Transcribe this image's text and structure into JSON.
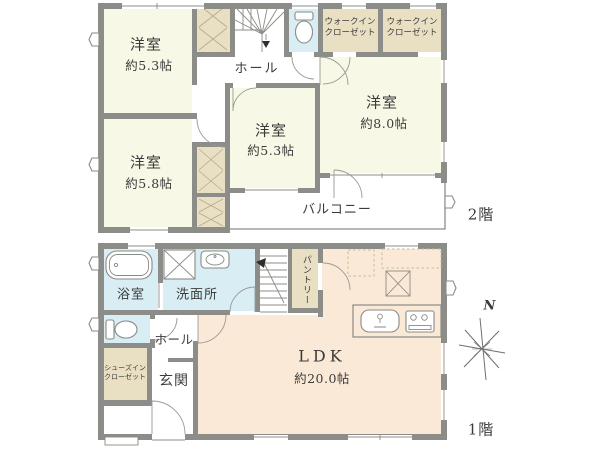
{
  "floor2": {
    "floor_label": "2階",
    "rooms": {
      "bedroom_nw": {
        "name": "洋室",
        "size": "約5.3帖"
      },
      "bedroom_sw": {
        "name": "洋室",
        "size": "約5.8帖"
      },
      "bedroom_center": {
        "name": "洋室",
        "size": "約5.3帖"
      },
      "bedroom_east": {
        "name": "洋室",
        "size": "約8.0帖"
      },
      "hall": {
        "name": "ホール"
      },
      "wic_left": {
        "name": "ウォークイン\nクローゼット"
      },
      "wic_right": {
        "name": "ウォークイン\nクローゼット"
      },
      "balcony": {
        "name": "バルコニー"
      }
    }
  },
  "floor1": {
    "floor_label": "1階",
    "rooms": {
      "bathroom": {
        "name": "浴室"
      },
      "washroom": {
        "name": "洗面所"
      },
      "pantry": {
        "name": "パントリー"
      },
      "hall": {
        "name": "ホール"
      },
      "entrance": {
        "name": "玄関"
      },
      "shoes_closet": {
        "name": "シューズイン\nクローゼット"
      },
      "ldk": {
        "name": "LDK",
        "size": "約20.0帖"
      }
    }
  },
  "compass": {
    "north_label": "N"
  },
  "palette": {
    "wall": "#8c8c88",
    "bedroom_fill": "#f7f8e6",
    "closet_fill": "#e9e0c4",
    "wet_fill": "#d8edf4",
    "ldk_fill": "#fbe9d7",
    "outline": "#8c8c88",
    "text": "#3b3b3b"
  }
}
